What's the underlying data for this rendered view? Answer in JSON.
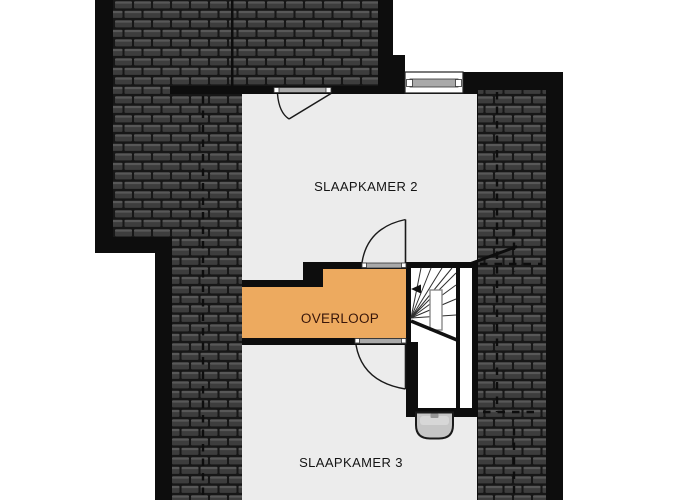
{
  "plan": {
    "type": "floor-plan",
    "floor": "upper-floor",
    "rooms": {
      "slaapkamer2": {
        "label": "SLAAPKAMER 2"
      },
      "overloop": {
        "label": "OVERLOOP"
      },
      "slaapkamer3": {
        "label": "SLAAPKAMER 3"
      }
    },
    "symbols": {
      "window": "window-in-top-wall",
      "door_slaapkamer2_exterior": "swing-door-top-wall",
      "door_slaapkamer2_overloop": "swing-door",
      "door_overloop_slaapkamer3": "swing-door",
      "staircase": "winder-staircase",
      "stairs_direction_arrow": "left",
      "fixture": "washbasin",
      "roof": "dark-tiled-sloped-roof",
      "headroom_lines": "dashed"
    },
    "colors": {
      "outside": "#ffffff",
      "wall": "#0d0d0d",
      "room_fill": "#ececec",
      "hallway_fill": "#edaa5f",
      "roof_gap": "#171717",
      "roof_tile": "#3d3d3d",
      "roof_tile_highlight": "#585858",
      "threshold": "#a9a9a9",
      "stair_void": "#ffffff",
      "fixture_fill": "#c6c6c6",
      "label": "#141414",
      "hallway_label": "#38160a"
    }
  }
}
